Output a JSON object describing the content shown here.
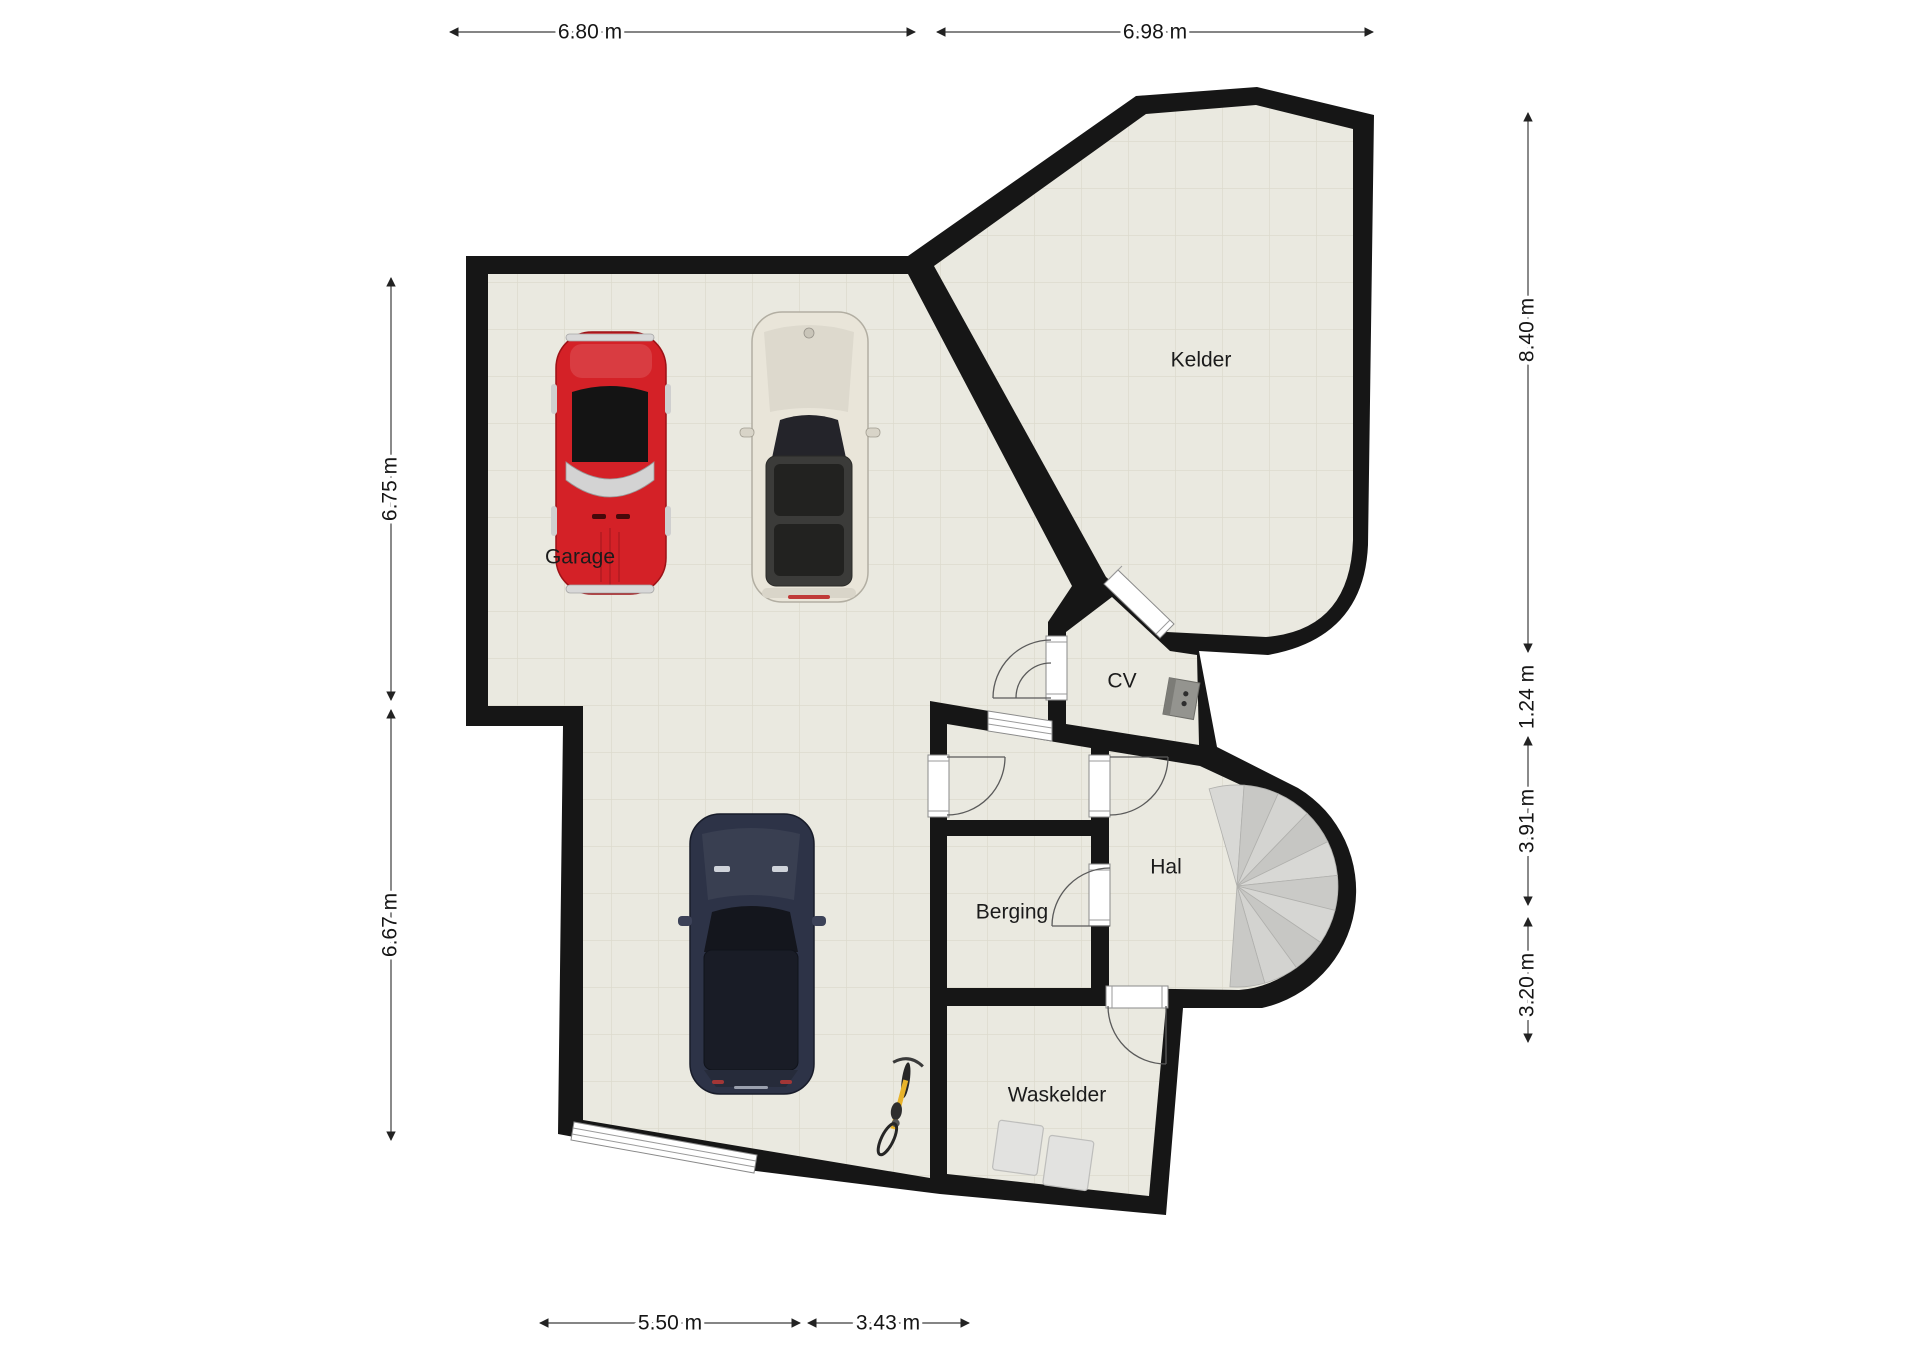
{
  "plan": {
    "rooms": [
      {
        "label": "Garage"
      },
      {
        "label": "Kelder"
      },
      {
        "label": "CV"
      },
      {
        "label": "Hal"
      },
      {
        "label": "Berging"
      },
      {
        "label": "Waskelder"
      }
    ],
    "dimensions": {
      "top": [
        {
          "value": "6.80 m"
        },
        {
          "value": "6.98 m"
        }
      ],
      "left": [
        {
          "value": "6.75 m"
        },
        {
          "value": "6.67 m"
        }
      ],
      "right": [
        {
          "value": "8.40 m"
        },
        {
          "value": "1.24 m"
        },
        {
          "value": "3.91 m"
        },
        {
          "value": "3.20 m"
        }
      ],
      "bottom": [
        {
          "value": "5.50 m"
        },
        {
          "value": "3.43 m"
        }
      ]
    },
    "colors": {
      "wall": "#161616",
      "floor": "#eae9e0",
      "grid": "#dcdacd",
      "stair_light": "#d8d8d5",
      "stair_dark": "#c8c8c5",
      "red_car": "#d42127",
      "white_car": "#e9e5d9",
      "dark_car": "#2d3347",
      "bike": "#e8b32a",
      "appliance": "#e2e2e0",
      "boiler": "#94948f"
    },
    "objects": [
      {
        "name": "classic-car-red"
      },
      {
        "name": "compact-car-white"
      },
      {
        "name": "suv-car-dark"
      },
      {
        "name": "bicycle"
      },
      {
        "name": "washing-machines"
      },
      {
        "name": "cv-boiler"
      },
      {
        "name": "spiral-staircase"
      },
      {
        "name": "garage-door"
      }
    ]
  }
}
